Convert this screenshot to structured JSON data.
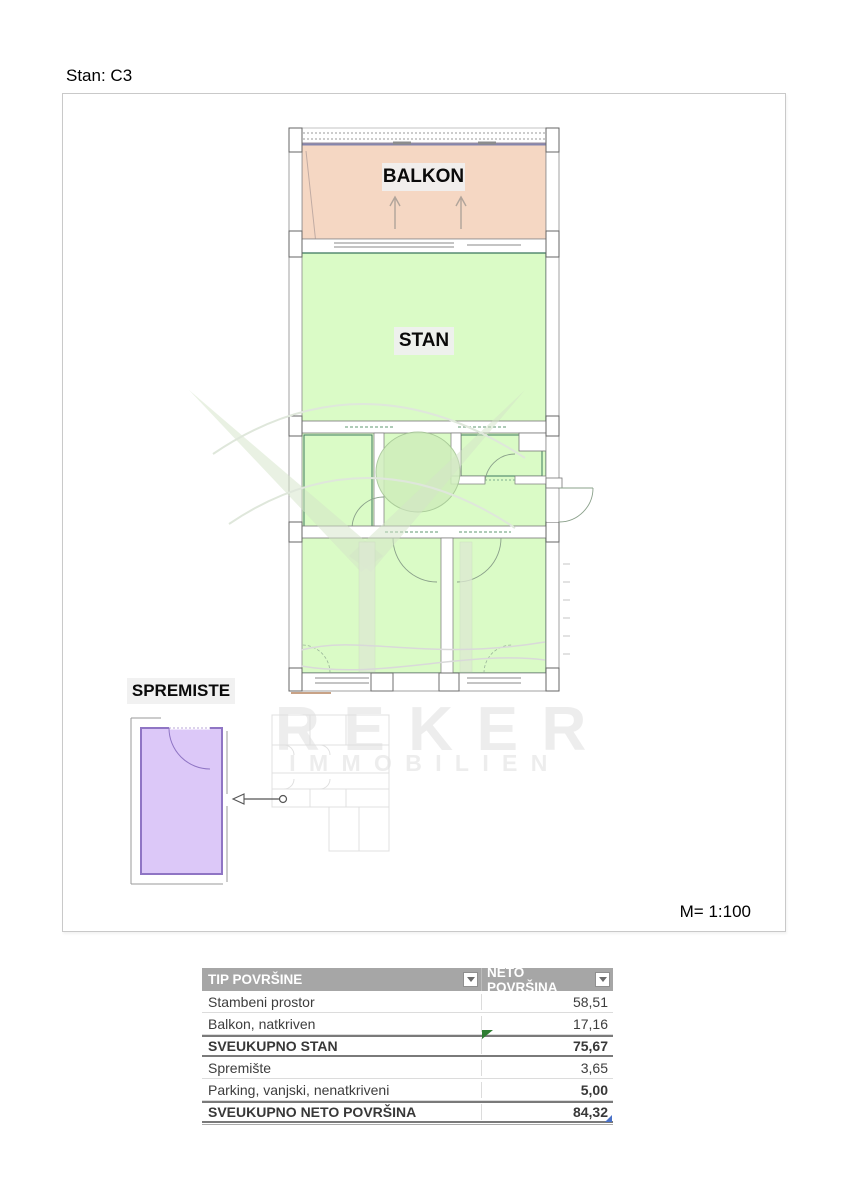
{
  "page": {
    "title": "Stan: C3",
    "scale_label": "M= 1:100"
  },
  "plan": {
    "balcony_label": "BALKON",
    "apartment_label": "STAN",
    "storage_label": "SPREMISTE",
    "colors": {
      "balcony_fill": "#f5d7c3",
      "apartment_fill": "#dafbc6",
      "storage_fill": "#dcc8f8"
    }
  },
  "watermark": {
    "line1": "REKER",
    "line2": "IMMOBILIEN"
  },
  "table": {
    "headers": [
      {
        "label": "TIP POVRŠINE"
      },
      {
        "label": "NETO POVRŠINA"
      }
    ],
    "rows": [
      {
        "label": "Stambeni prostor",
        "value": "58,51"
      },
      {
        "label": "Balkon, natkriven",
        "value": "17,16"
      },
      {
        "label": "SVEUKUPNO STAN",
        "value": "75,67"
      },
      {
        "label": "Spremište",
        "value": "3,65"
      },
      {
        "label": "Parking, vanjski, nenatkriveni",
        "value": "5,00"
      },
      {
        "label": "SVEUKUPNO NETO POVRŠINA",
        "value": "84,32"
      }
    ]
  }
}
